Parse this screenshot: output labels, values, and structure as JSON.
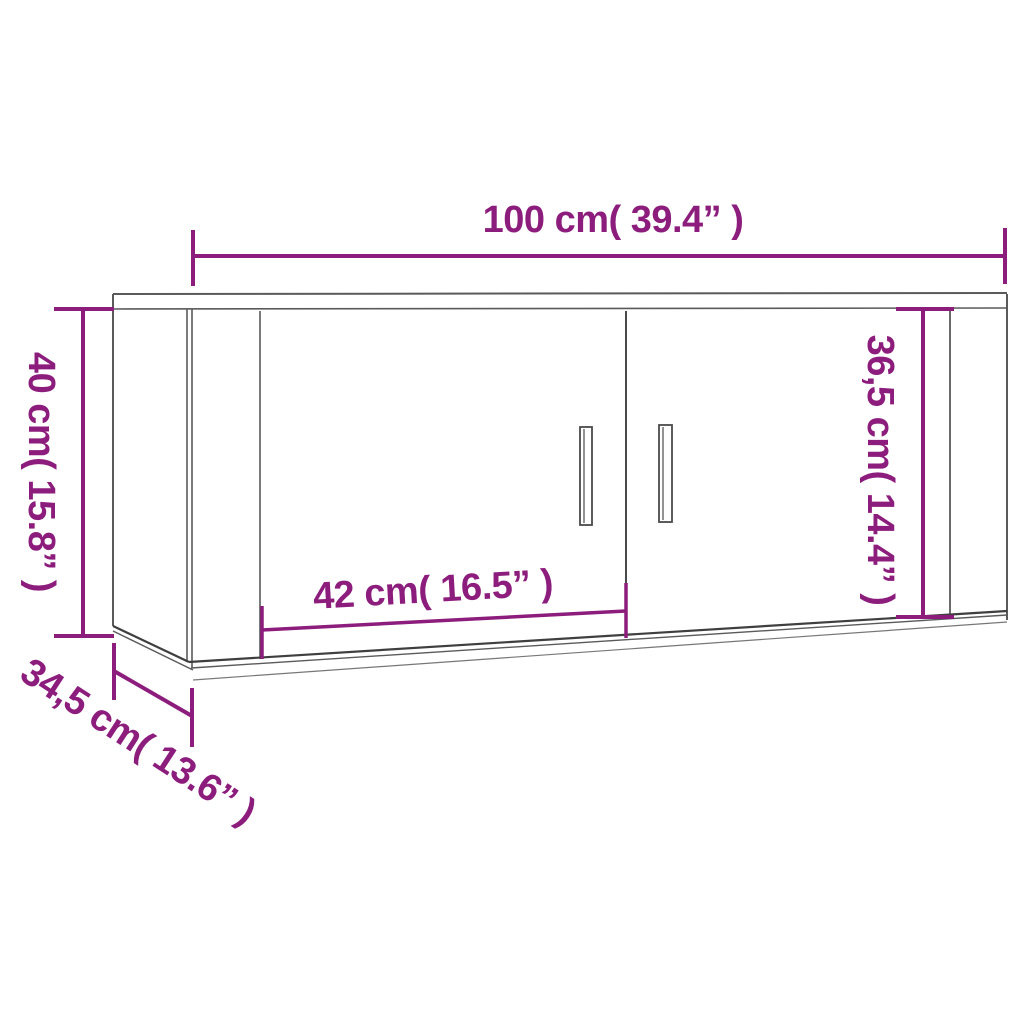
{
  "colors": {
    "accent": "#8c1d7c",
    "line": "#5a5a5a",
    "line_dark": "#3f3f3f",
    "background": "#ffffff"
  },
  "dimensions": {
    "width": {
      "label": "100 cm( 39.4”  )",
      "cm": 100,
      "inches": 39.4
    },
    "height": {
      "label": "40 cm( 15.8”  )",
      "cm": 40,
      "inches": 15.8
    },
    "door_height": {
      "label": "36,5 cm( 14.4”  )",
      "cm": 36.5,
      "inches": 14.4
    },
    "door_width": {
      "label": "42 cm( 16.5”  )",
      "cm": 42,
      "inches": 16.5
    },
    "depth": {
      "label": "34,5 cm( 13.6”  )",
      "cm": 34.5,
      "inches": 13.6
    }
  }
}
